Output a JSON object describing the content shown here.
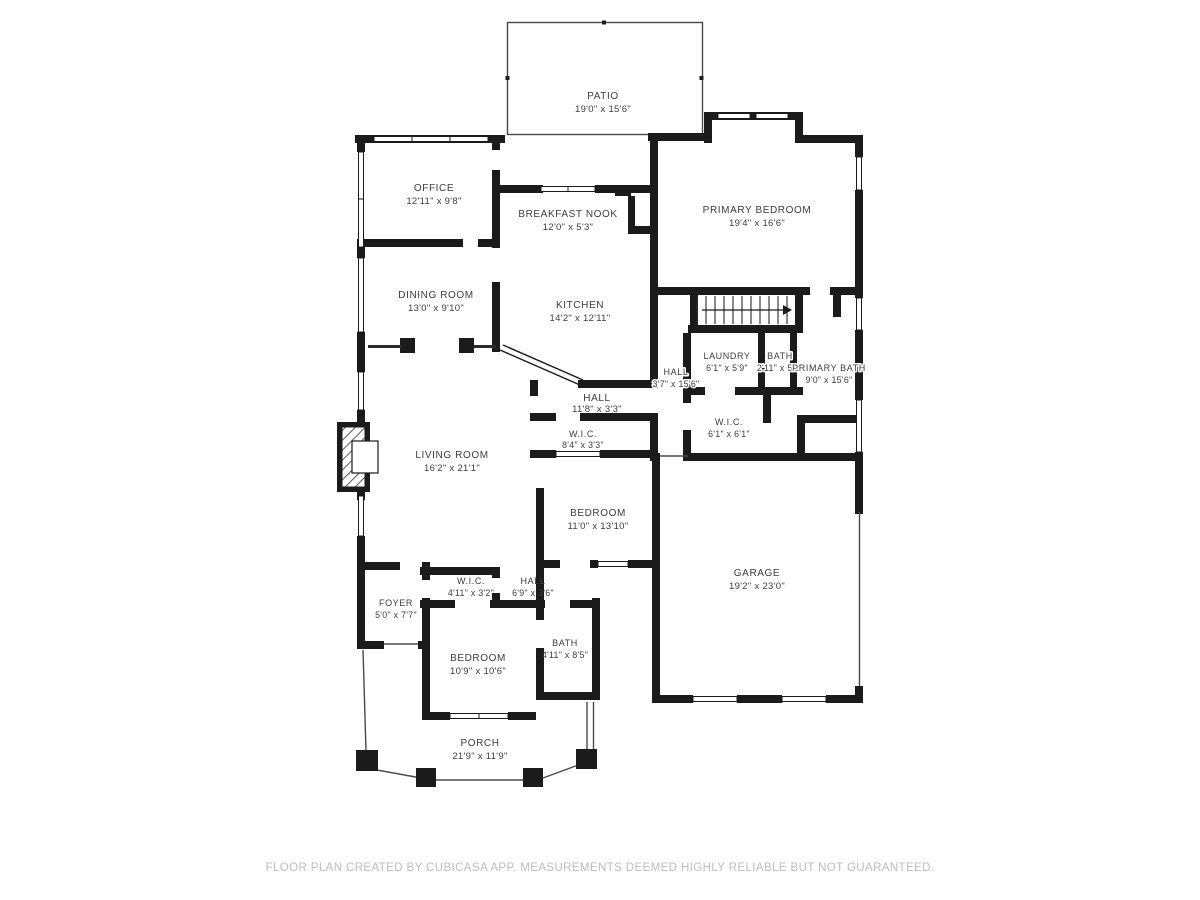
{
  "plan": {
    "creator_note": "FLOOR PLAN CREATED BY CUBICASA APP. MEASUREMENTS DEEMED HIGHLY RELIABLE BUT NOT GUARANTEED.",
    "colors": {
      "wall": "#1b1b1b",
      "label": "#3d3d3d",
      "outline": "#4a4a4a",
      "footer": "#bdbdbd",
      "background": "#ffffff"
    }
  },
  "rooms": {
    "patio": {
      "name": "PATIO",
      "dims": "19'0\" x 15'6\""
    },
    "office": {
      "name": "OFFICE",
      "dims": "12'11\" x 9'8\""
    },
    "breakfast_nook": {
      "name": "BREAKFAST NOOK",
      "dims": "12'0\" x 5'3\""
    },
    "primary_bedroom": {
      "name": "PRIMARY BEDROOM",
      "dims": "19'4\" x 16'6\""
    },
    "dining_room": {
      "name": "DINING ROOM",
      "dims": "13'0\" x 9'10\""
    },
    "kitchen": {
      "name": "KITCHEN",
      "dims": "14'2\" x 12'11\""
    },
    "hall_upper": {
      "name": "HALL",
      "dims": "3'7\" x 15'6\""
    },
    "laundry": {
      "name": "LAUNDRY",
      "dims": "6'1\" x 5'9\""
    },
    "bath_small": {
      "name": "BATH",
      "dims": "2'11\" x 5'9\""
    },
    "primary_bath": {
      "name": "PRIMARY BATH",
      "dims": "9'0\" x 15'6\""
    },
    "hall_mid": {
      "name": "HALL",
      "dims": "11'8\" x 3'3\""
    },
    "wic_mid": {
      "name": "W.I.C.",
      "dims": "8'4\" x 3'3\""
    },
    "wic_primary": {
      "name": "W.I.C.",
      "dims": "6'1\" x 6'1\""
    },
    "living_room": {
      "name": "LIVING ROOM",
      "dims": "16'2\" x 21'1\""
    },
    "bedroom_mid": {
      "name": "BEDROOM",
      "dims": "11'0\" x 13'10\""
    },
    "garage": {
      "name": "GARAGE",
      "dims": "19'2\" x 23'0\""
    },
    "wic_small": {
      "name": "W.I.C.",
      "dims": "4'11\" x 3'2\""
    },
    "hall_small": {
      "name": "HALL",
      "dims": "6'9\" x 3'6\""
    },
    "foyer": {
      "name": "FOYER",
      "dims": "5'0\" x 7'7\""
    },
    "bedroom_bottom": {
      "name": "BEDROOM",
      "dims": "10'9\" x 10'6\""
    },
    "bath_bottom": {
      "name": "BATH",
      "dims": "4'11\" x 8'5\""
    },
    "porch": {
      "name": "PORCH",
      "dims": "21'9\" x 11'9\""
    }
  }
}
